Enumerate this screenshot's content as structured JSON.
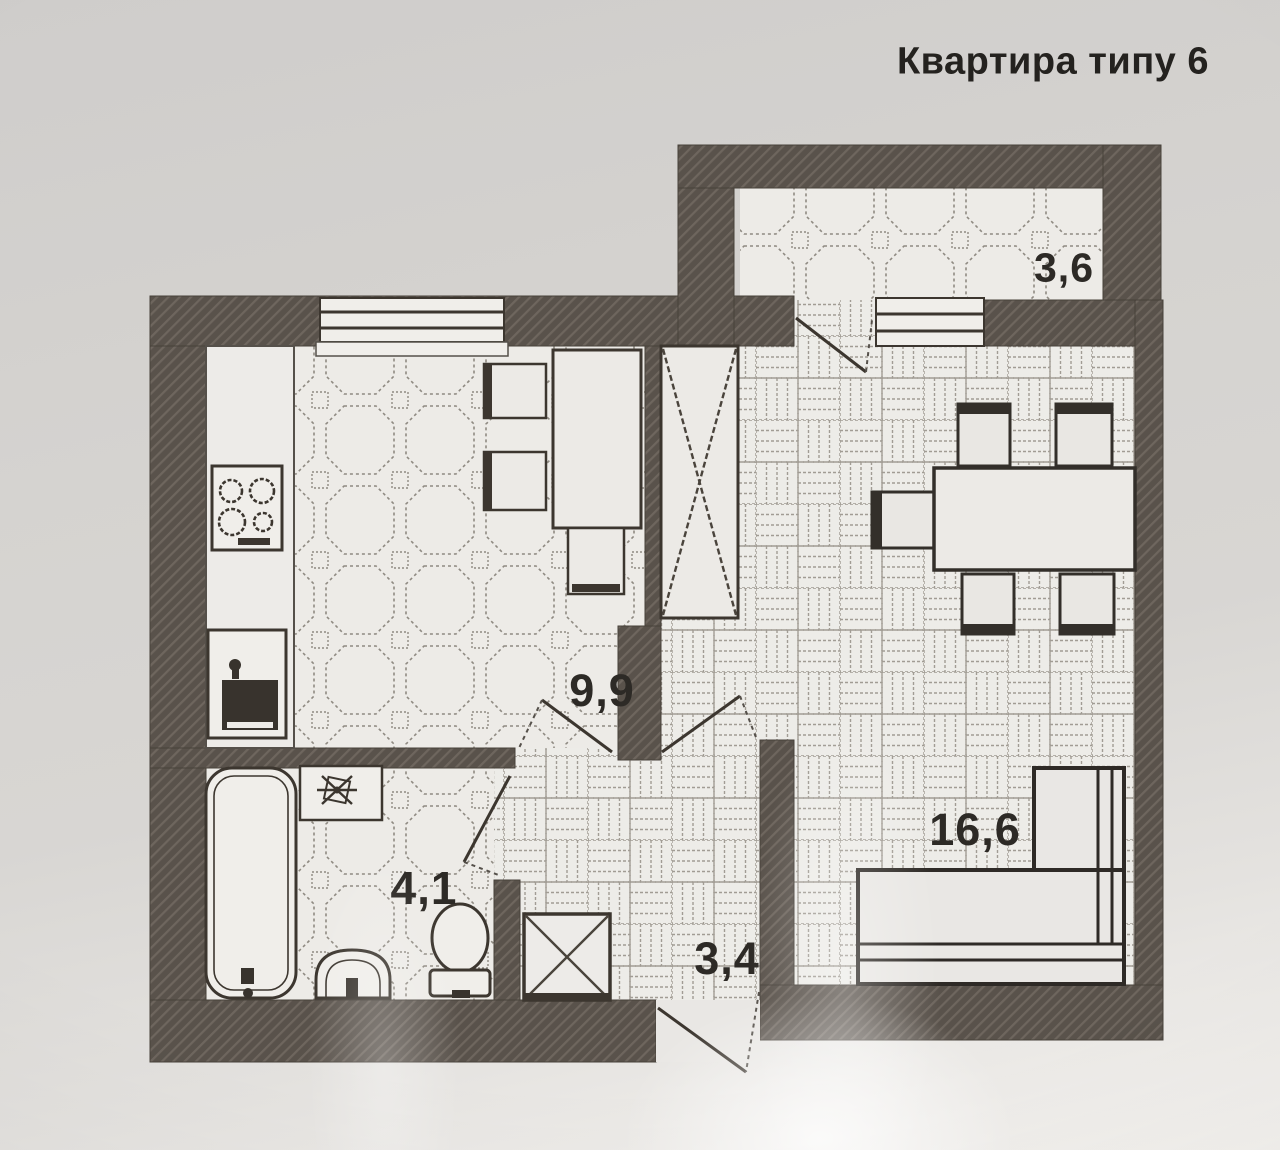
{
  "title": "Квартира типу 6",
  "rooms": {
    "balcony": {
      "name": "balcony",
      "area": "3,6"
    },
    "kitchen": {
      "name": "kitchen",
      "area": "9,9"
    },
    "bathroom": {
      "name": "bathroom",
      "area": "4,1"
    },
    "hall": {
      "name": "hallway",
      "area": "3,4"
    },
    "living": {
      "name": "living-room",
      "area": "16,6"
    }
  },
  "colors": {
    "wall": "#59524b",
    "wall_hatch": "#6e665e",
    "floor": "#edebe7",
    "line": "#3c362f",
    "paper": "#d6d4d1"
  },
  "icons": [
    "stove-icon",
    "kitchen-sink-icon",
    "bathtub-icon",
    "washbasin-icon",
    "toilet-icon",
    "fan-appliance-icon",
    "wardrobe-icon",
    "vent-shaft-icon",
    "dining-table-icon",
    "chair-icon",
    "stool-icon",
    "sofa-icon",
    "window-icon",
    "door-swing-icon"
  ]
}
